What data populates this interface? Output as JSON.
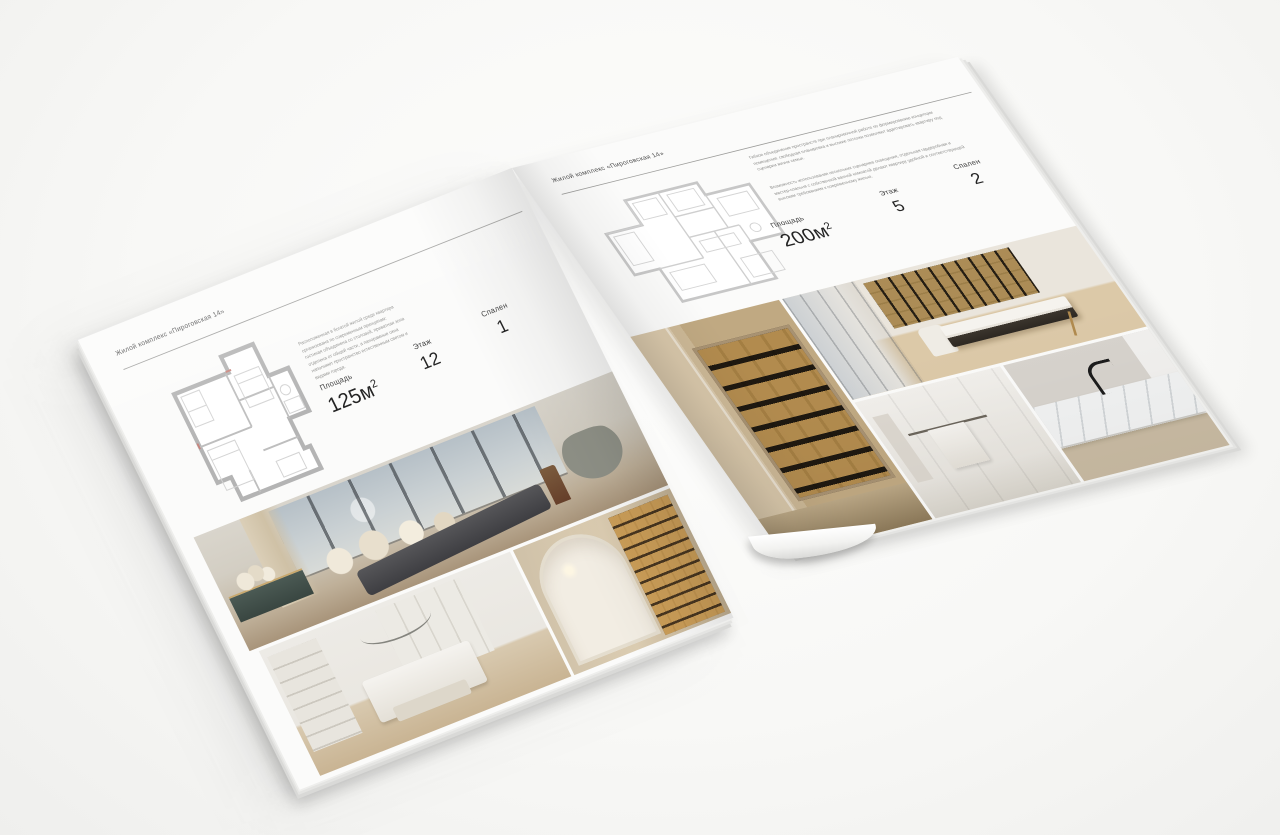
{
  "scene": {
    "background": "#f8f8f6",
    "paper_color": "#fbfbfa"
  },
  "brochure": {
    "left_page": {
      "header": "Жилой комплекс «Пироговская 14»",
      "description": "Расположенная в богатой жилой среде квартира организована по современным принципам: гостиная объединена со столовой, приватная зона отделена от общей части, а панорамные окна наполняют пространство естественным светом и видами города.",
      "stats": {
        "area_label": "Площадь",
        "area_value": "125м",
        "area_sup": "2",
        "floor_label": "Этаж",
        "floor_value": "12",
        "bedrooms_label": "Спален",
        "bedrooms_value": "1"
      },
      "photos": [
        "bedroom-panorama",
        "white-bedroom",
        "library-hallway"
      ]
    },
    "right_page": {
      "header": "Жилой комплекс «Пироговская 14»",
      "description_1": "Гибкое объединение пространств при планировочной работе по формированию концепции помещения: свободная планировка и высокие потолки позволяют адаптировать квартиру под сценарии жизни семьи.",
      "description_2": "Возможность использования нескольких сценариев освещения, отдельная гардеробная и мастер-спальня с собственной ванной комнатой делают квартиру удобной и соответствующей высоким требованиям к современному жилью.",
      "stats": {
        "area_label": "Площадь",
        "area_value": "200м",
        "area_sup": "2",
        "floor_label": "Этаж",
        "floor_value": "5",
        "bedrooms_label": "Спален",
        "bedrooms_value": "2"
      },
      "photos": [
        "cabinet-corridor",
        "study-room",
        "bathroom",
        "marble-vanity"
      ]
    }
  }
}
